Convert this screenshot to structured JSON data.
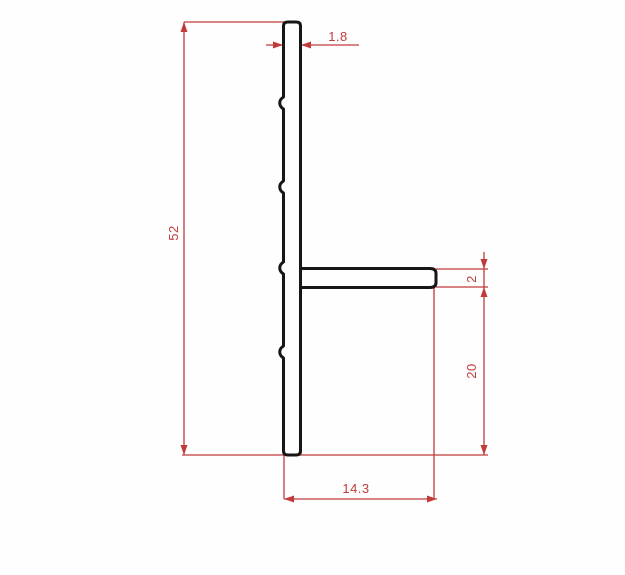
{
  "drawing": {
    "kind": "technical-profile-cross-section",
    "background_color": "#fefefe",
    "outline_color": "#161616",
    "dimension_color": "#c13b3b",
    "dimensions": [
      {
        "id": "web-thickness-top",
        "label": "1.8",
        "orientation": "horizontal"
      },
      {
        "id": "overall-height",
        "label": "52",
        "orientation": "vertical"
      },
      {
        "id": "flange-thickness",
        "label": "2",
        "orientation": "vertical"
      },
      {
        "id": "flange-to-bottom",
        "label": "20",
        "orientation": "vertical"
      },
      {
        "id": "bottom-width",
        "label": "14.3",
        "orientation": "horizontal"
      }
    ]
  }
}
